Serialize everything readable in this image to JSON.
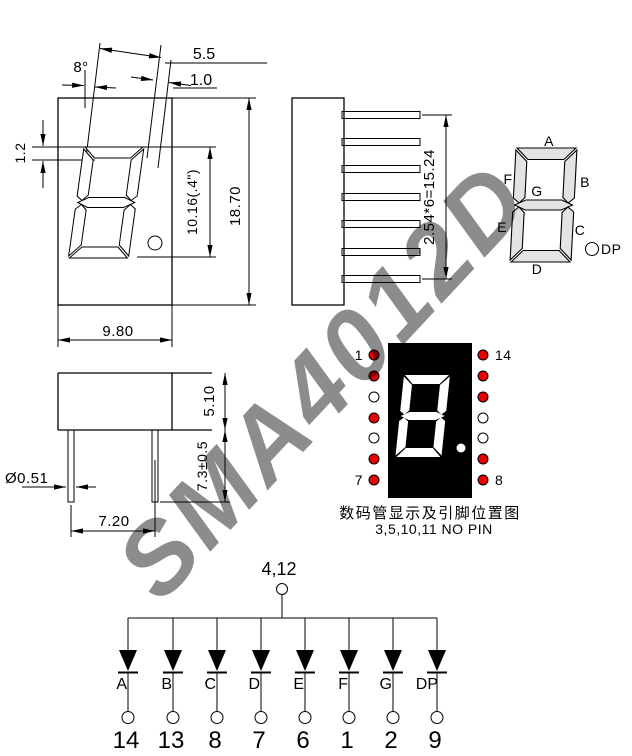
{
  "watermark": {
    "text": "SMA4012D",
    "color": "#4f86dd"
  },
  "front_view": {
    "dim_angle": "8°",
    "dim_seg_top_offset": "5.5",
    "dim_seg_width": "1.0",
    "dim_seg_thickness": "1.2",
    "dim_digit_height": "10.16(.4\")",
    "dim_overall_height": "18.70",
    "dim_overall_width": "9.80"
  },
  "side_view": {
    "dim_pin_pitch": "2.54*6=15.24"
  },
  "profile_view": {
    "dim_body_thickness": "5.10",
    "dim_lead_length": "7.3±0.5",
    "dim_lead_diameter": "Ø0.51",
    "dim_lead_span": "7.20"
  },
  "segment_diagram": {
    "seg_a": "A",
    "seg_b": "B",
    "seg_c": "C",
    "seg_d": "D",
    "seg_e": "E",
    "seg_f": "F",
    "seg_g": "G",
    "seg_dp": "DP"
  },
  "pin_diagram": {
    "pin_top_left": "1",
    "pin_bottom_left": "7",
    "pin_top_right": "14",
    "pin_bottom_right": "8",
    "left_dots": [
      "red",
      "red",
      "white",
      "red",
      "white",
      "red",
      "red"
    ],
    "right_dots": [
      "red",
      "red",
      "red",
      "white",
      "white",
      "red",
      "red"
    ],
    "dot_red": "#e60000",
    "caption_line1": "数码管显示及引脚位置图",
    "caption_line2": "3,5,10,11 NO PIN"
  },
  "schematic": {
    "common_pin_label": "4,12",
    "segment_labels": [
      "A",
      "B",
      "C",
      "D",
      "E",
      "F",
      "G",
      "DP"
    ],
    "pin_numbers": [
      "14",
      "13",
      "8",
      "7",
      "6",
      "1",
      "2",
      "9"
    ]
  }
}
